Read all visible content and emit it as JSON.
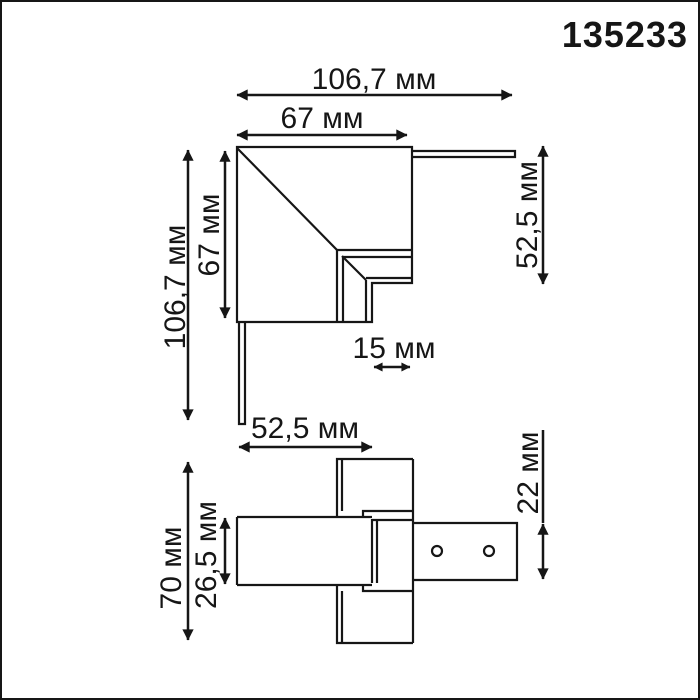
{
  "page": {
    "background": "#ffffff",
    "line_color": "#161616"
  },
  "header": {
    "part_number": "135233"
  },
  "top_view": {
    "dim_total_width": "106,7 мм",
    "dim_body_width": "67 мм",
    "dim_total_height": "106,7 мм",
    "dim_body_height": "67 мм",
    "dim_right_arm": "52,5 мм",
    "dim_notch": "15 мм",
    "dim_bottom_arm": "52,5 мм"
  },
  "side_view": {
    "dim_total_height": "70 мм",
    "dim_body_thickness": "26,5 мм",
    "dim_adapter_plate": "22 мм"
  }
}
